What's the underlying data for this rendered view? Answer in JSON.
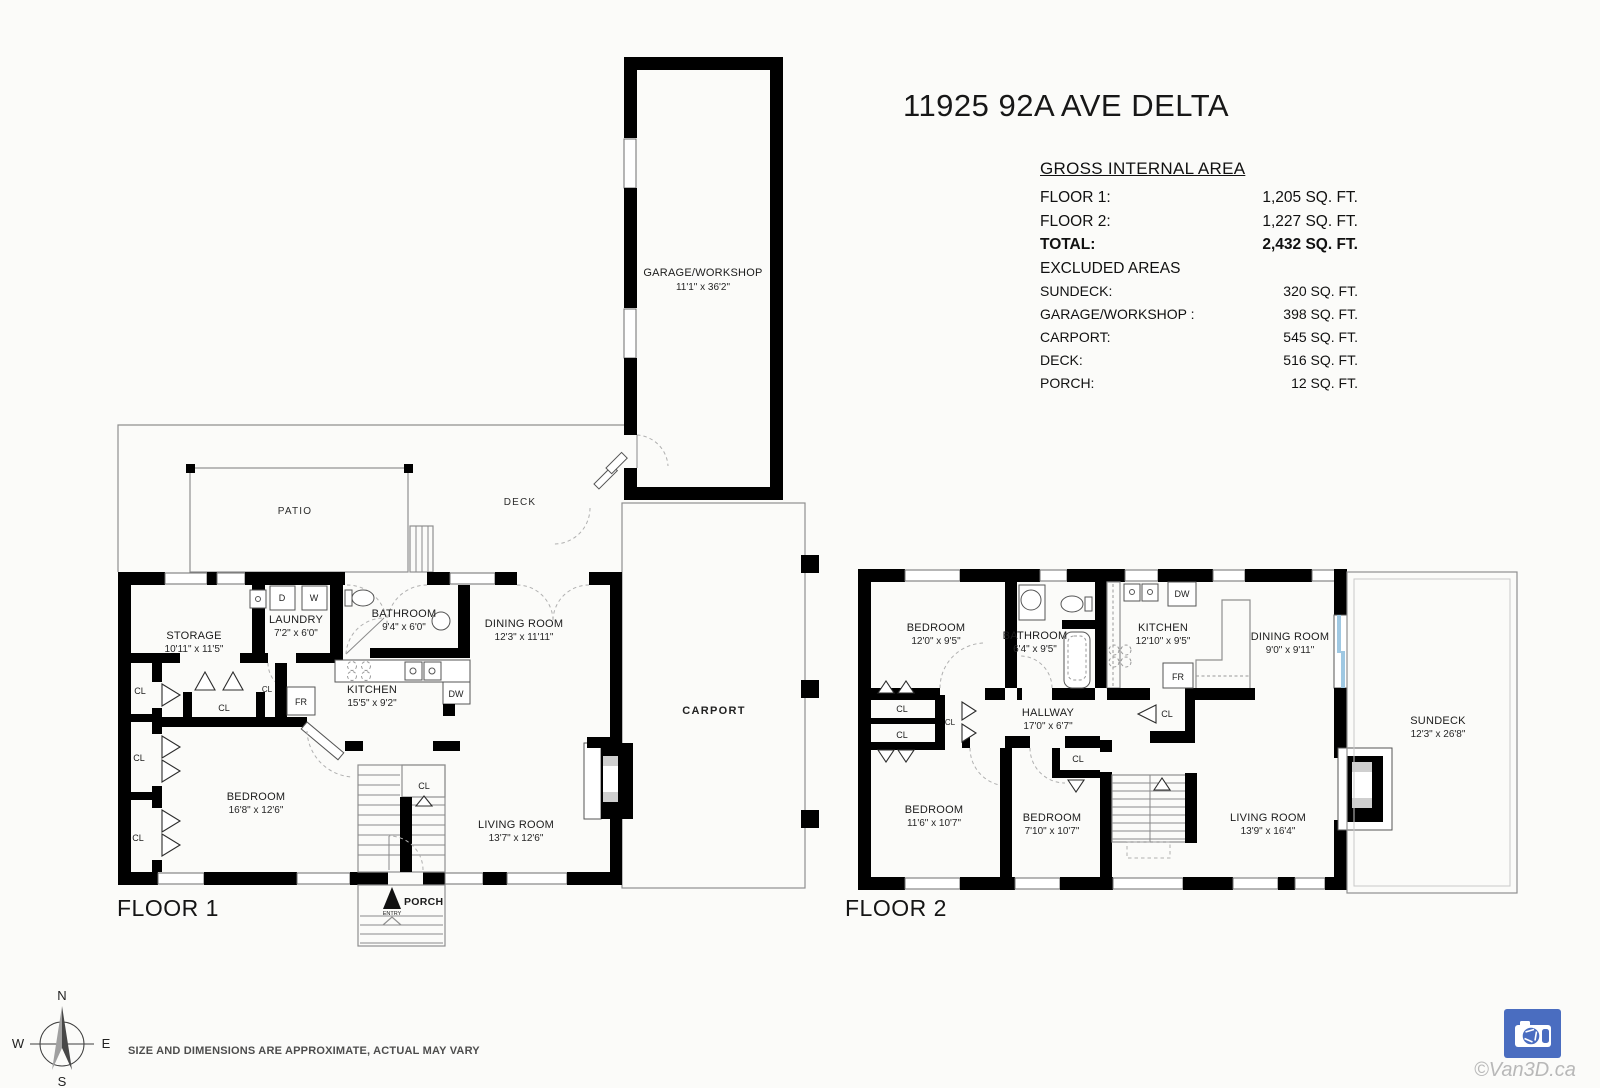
{
  "title": "11925 92A AVE DELTA",
  "area_table": {
    "heading": "GROSS INTERNAL AREA",
    "rows": [
      {
        "label": "FLOOR 1:",
        "value": "1,205 SQ. FT."
      },
      {
        "label": "FLOOR 2:",
        "value": "1,227 SQ. FT."
      },
      {
        "label": "TOTAL:",
        "value": "2,432 SQ. FT."
      },
      {
        "label": "EXCLUDED AREAS",
        "value": ""
      },
      {
        "label": "SUNDECK:",
        "value": "320 SQ. FT."
      },
      {
        "label": "GARAGE/WORKSHOP :",
        "value": "398 SQ. FT."
      },
      {
        "label": "CARPORT:",
        "value": "545 SQ. FT."
      },
      {
        "label": "DECK:",
        "value": "516 SQ. FT."
      },
      {
        "label": "PORCH:",
        "value": "12 SQ. FT."
      }
    ]
  },
  "floor1": {
    "label": "FLOOR 1",
    "rooms": {
      "garage": {
        "name": "GARAGE/WORKSHOP",
        "dims": "11'1\" x 36'2\""
      },
      "patio": {
        "name": "PATIO"
      },
      "deck": {
        "name": "DECK"
      },
      "carport": {
        "name": "CARPORT"
      },
      "storage": {
        "name": "STORAGE",
        "dims": "10'11\" x 11'5\""
      },
      "laundry": {
        "name": "LAUNDRY",
        "dims": "7'2\" x 6'0\""
      },
      "bathroom": {
        "name": "BATHROOM",
        "dims": "9'4\" x 6'0\""
      },
      "dining": {
        "name": "DINING ROOM",
        "dims": "12'3\" x 11'11\""
      },
      "kitchen": {
        "name": "KITCHEN",
        "dims": "15'5\" x 9'2\""
      },
      "bedroom": {
        "name": "BEDROOM",
        "dims": "16'8\" x 12'6\""
      },
      "living": {
        "name": "LIVING ROOM",
        "dims": "13'7\" x 12'6\""
      },
      "porch": {
        "name": "PORCH"
      },
      "entry": "ENTRY"
    }
  },
  "floor2": {
    "label": "FLOOR 2",
    "rooms": {
      "bedroom1": {
        "name": "BEDROOM",
        "dims": "12'0\" x 9'5\""
      },
      "bathroom": {
        "name": "BATHROOM",
        "dims": "6'4\" x 9'5\""
      },
      "kitchen": {
        "name": "KITCHEN",
        "dims": "12'10\" x 9'5\""
      },
      "dining": {
        "name": "DINING ROOM",
        "dims": "9'0\" x 9'11\""
      },
      "hallway": {
        "name": "HALLWAY",
        "dims": "17'0\" x 6'7\""
      },
      "bedroom2": {
        "name": "BEDROOM",
        "dims": "11'6\" x 10'7\""
      },
      "bedroom3": {
        "name": "BEDROOM",
        "dims": "7'10\" x 10'7\""
      },
      "living": {
        "name": "LIVING ROOM",
        "dims": "13'9\" x 16'4\""
      },
      "sundeck": {
        "name": "SUNDECK",
        "dims": "12'3\" x 26'8\""
      }
    }
  },
  "labels": {
    "closet": "CL",
    "dryer": "D",
    "washer": "W",
    "fridge": "FR",
    "dishwasher": "DW"
  },
  "compass": {
    "n": "N",
    "e": "E",
    "s": "S",
    "w": "W"
  },
  "footer": {
    "disclaimer": "SIZE AND DIMENSIONS ARE APPROXIMATE, ACTUAL MAY VARY",
    "watermark": "©Van3D.ca"
  },
  "colors": {
    "wall": "#000000",
    "logo_blue": "#4a6dc0",
    "window_blue": "#9fc8e2",
    "watermark_gray": "#b8b8b8"
  }
}
